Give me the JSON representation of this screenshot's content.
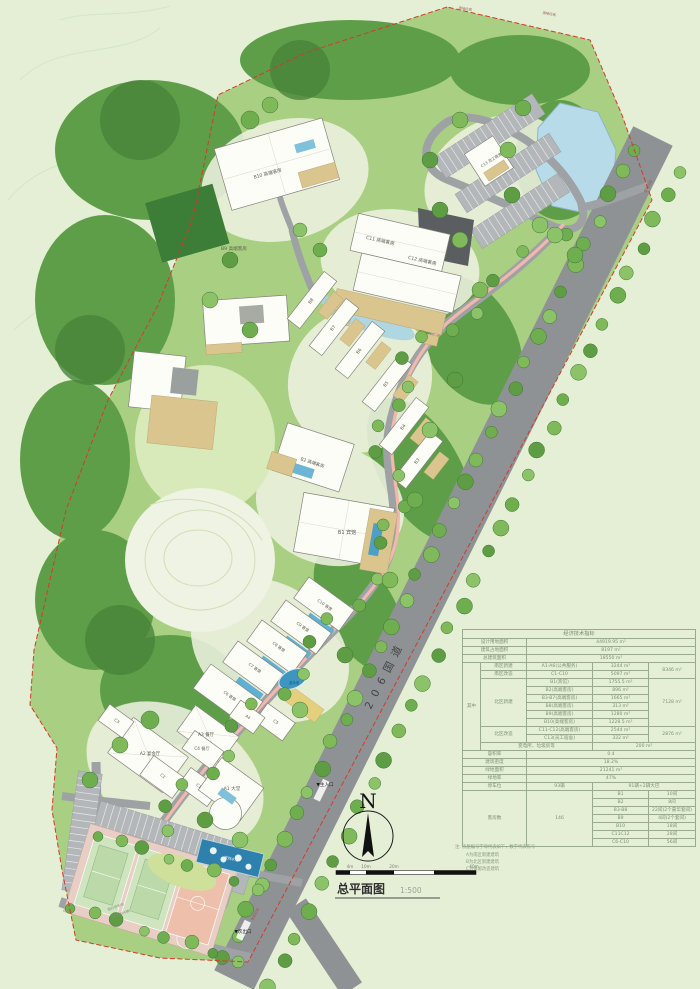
{
  "page": {
    "title": "总平面图",
    "scale": "1:500"
  },
  "north_label": "N",
  "scalebar": {
    "ticks": [
      "0",
      "4m",
      "10m",
      "20m",
      "40m"
    ]
  },
  "notes": {
    "title": "注: 房屋编号字母代表如下，数字代表栋号",
    "lines": [
      "A为南区新建建筑",
      "B为北区新建建筑",
      "C为保留改造建筑"
    ]
  },
  "table": {
    "title": "经济技术指标",
    "rows": [
      [
        {
          "t": "设计用地面积",
          "cs": 2
        },
        {
          "t": "44919.95 m²",
          "cs": 3
        }
      ],
      [
        {
          "t": "建筑占地面积",
          "cs": 2
        },
        {
          "t": "8197 m²",
          "cs": 3
        }
      ],
      [
        {
          "t": "总建筑面积",
          "cs": 2
        },
        {
          "t": "18550 m²",
          "cs": 3
        }
      ],
      [
        {
          "t": "其中",
          "rs": 11
        },
        {
          "t": "南区新建"
        },
        {
          "t": "A1-A6(公共服务)"
        },
        {
          "t": "3244 m²"
        },
        {
          "t": "8346 m²",
          "rs": 2
        }
      ],
      [
        {
          "t": "南区改造"
        },
        {
          "t": "C1-C10"
        },
        {
          "t": "5097 m²"
        }
      ],
      [
        {
          "t": "北区新建",
          "rs": 6
        },
        {
          "t": "B1(宾馆)"
        },
        {
          "t": "1755.5 m²"
        },
        {
          "t": "7128 m²",
          "rs": 6
        }
      ],
      [
        {
          "t": "B2(高端客房)"
        },
        {
          "t": "896 m²"
        }
      ],
      [
        {
          "t": "B3-B7(高端客房)"
        },
        {
          "t": "1665 m²"
        }
      ],
      [
        {
          "t": "B8(高端客房)"
        },
        {
          "t": "313 m²"
        }
      ],
      [
        {
          "t": "B9(高端客房)"
        },
        {
          "t": "1280 m²"
        }
      ],
      [
        {
          "t": "B10(高端客房)"
        },
        {
          "t": "1228.5 m²"
        }
      ],
      [
        {
          "t": "北区改造",
          "rs": 2
        },
        {
          "t": "C11-C12(高端客房)"
        },
        {
          "t": "2544 m²"
        },
        {
          "t": "2876 m²",
          "rs": 2
        }
      ],
      [
        {
          "t": "C13(员工宿舍)"
        },
        {
          "t": "332 m²"
        }
      ],
      [
        {
          "t": "变电所、垃圾房等",
          "cs": 2
        },
        {
          "t": "200 m²",
          "cs": 2
        }
      ],
      [
        {
          "t": "容积率",
          "cs": 2
        },
        {
          "t": "0.4",
          "cs": 3
        }
      ],
      [
        {
          "t": "建筑密度",
          "cs": 2
        },
        {
          "t": "18.2%",
          "cs": 3
        }
      ],
      [
        {
          "t": "绿地面积",
          "cs": 2
        },
        {
          "t": "21241 m²",
          "cs": 3
        }
      ],
      [
        {
          "t": "绿地率",
          "cs": 2
        },
        {
          "t": "47%",
          "cs": 3
        }
      ],
      [
        {
          "t": "停车位",
          "cs": 2
        },
        {
          "t": "93辆"
        },
        {
          "t": "91辆+2辆大巴",
          "cs": 2
        }
      ],
      [
        {
          "t": "客房数",
          "cs": 2,
          "rs": 7
        },
        {
          "t": "146",
          "rs": 7
        },
        {
          "t": "B1"
        },
        {
          "t": "10间"
        }
      ],
      [
        {
          "t": "B2"
        },
        {
          "t": "8间"
        }
      ],
      [
        {
          "t": "B3-B8"
        },
        {
          "t": "22间(2个豪华套间)"
        }
      ],
      [
        {
          "t": "B9"
        },
        {
          "t": "4间(2个套间)"
        }
      ],
      [
        {
          "t": "B10"
        },
        {
          "t": "18间"
        }
      ],
      [
        {
          "t": "C11C12"
        },
        {
          "t": "28间"
        }
      ],
      [
        {
          "t": "C6-C10"
        },
        {
          "t": "56间"
        }
      ]
    ]
  },
  "map_labels": [
    {
      "n": "label-b10",
      "t": "B10 高端客房",
      "x": 268,
      "y": 175,
      "r": -15,
      "s": 4.6
    },
    {
      "n": "label-b9",
      "t": "B9 高端客房",
      "x": 234,
      "y": 250,
      "r": 0,
      "s": 4.6
    },
    {
      "n": "label-c11",
      "t": "C11 高端客房",
      "x": 380,
      "y": 242,
      "r": 13,
      "s": 4.6
    },
    {
      "n": "label-c12",
      "t": "C12 高端客房",
      "x": 422,
      "y": 262,
      "r": 13,
      "s": 4.6
    },
    {
      "n": "label-c13",
      "t": "C13 员工宿舍",
      "x": 492,
      "y": 161,
      "r": -32,
      "s": 3.8
    },
    {
      "n": "label-b8",
      "t": "B8",
      "x": 312,
      "y": 302,
      "r": -52,
      "s": 4.4
    },
    {
      "n": "label-b7",
      "t": "B7",
      "x": 334,
      "y": 329,
      "r": -52,
      "s": 4.4
    },
    {
      "n": "label-b6",
      "t": "B6",
      "x": 360,
      "y": 352,
      "r": -52,
      "s": 4.4
    },
    {
      "n": "label-b5",
      "t": "B5",
      "x": 387,
      "y": 385,
      "r": -52,
      "s": 4.4
    },
    {
      "n": "label-b4",
      "t": "B4",
      "x": 404,
      "y": 428,
      "r": -52,
      "s": 4.4
    },
    {
      "n": "label-b3",
      "t": "B3",
      "x": 418,
      "y": 462,
      "r": -52,
      "s": 4.4
    },
    {
      "n": "label-b2",
      "t": "B2 高端客房",
      "x": 312,
      "y": 464,
      "r": 18,
      "s": 4.4
    },
    {
      "n": "label-b1",
      "t": "B1 宾馆",
      "x": 347,
      "y": 534,
      "r": 0,
      "s": 5
    },
    {
      "n": "label-c10",
      "t": "C10 客房",
      "x": 324,
      "y": 606,
      "r": 36,
      "s": 4
    },
    {
      "n": "label-c9",
      "t": "C9 客房",
      "x": 302,
      "y": 628,
      "r": 36,
      "s": 4
    },
    {
      "n": "label-c8",
      "t": "C8 客房",
      "x": 278,
      "y": 648,
      "r": 36,
      "s": 4
    },
    {
      "n": "label-c7",
      "t": "C7 客房",
      "x": 254,
      "y": 669,
      "r": 36,
      "s": 4
    },
    {
      "n": "label-c6",
      "t": "C6 客房",
      "x": 229,
      "y": 697,
      "r": 36,
      "s": 4
    },
    {
      "n": "label-c5",
      "t": "C5",
      "x": 275,
      "y": 723,
      "r": 36,
      "s": 4
    },
    {
      "n": "label-a4",
      "t": "A4",
      "x": 247,
      "y": 718,
      "r": 36,
      "s": 4
    },
    {
      "n": "label-a3",
      "t": "A3 餐厅",
      "x": 206,
      "y": 736,
      "r": 0,
      "s": 4.4
    },
    {
      "n": "label-c4",
      "t": "C4 餐厅",
      "x": 202,
      "y": 750,
      "r": 0,
      "s": 4.2
    },
    {
      "n": "label-a2",
      "t": "A2 宴会厅",
      "x": 150,
      "y": 755,
      "r": 0,
      "s": 4.4
    },
    {
      "n": "label-a1",
      "t": "A1 大堂",
      "x": 232,
      "y": 790,
      "r": 0,
      "s": 4.6
    },
    {
      "n": "label-c3",
      "t": "C3",
      "x": 116,
      "y": 722,
      "r": 36,
      "s": 4
    },
    {
      "n": "label-c2",
      "t": "C2",
      "x": 162,
      "y": 777,
      "r": 36,
      "s": 4
    },
    {
      "n": "label-c1",
      "t": "C1",
      "x": 198,
      "y": 787,
      "r": 36,
      "s": 4
    },
    {
      "n": "label-national-road",
      "t": "206国道",
      "x": 388,
      "y": 676,
      "r": -63,
      "s": 10.5,
      "c": "#434343",
      "ls": 7
    },
    {
      "n": "main-entrance-marker",
      "t": "▼主入口",
      "x": 325,
      "y": 786,
      "r": 0,
      "s": 4.6,
      "c": "#1f1f1f"
    },
    {
      "n": "secondary-exit-marker",
      "t": "▼次出口",
      "x": 243,
      "y": 933,
      "r": 0,
      "s": 4.6,
      "c": "#1f1f1f"
    },
    {
      "n": "boundary-label",
      "t": "用地红线",
      "x": 465,
      "y": 10,
      "r": 9,
      "s": 3.4,
      "c": "#97564c"
    },
    {
      "n": "boundary-label",
      "t": "用地红线",
      "x": 549,
      "y": 15,
      "r": 10,
      "s": 3.4,
      "c": "#97564c"
    },
    {
      "n": "boundary-label",
      "t": "用地红线",
      "x": 649,
      "y": 187,
      "r": -62,
      "s": 3.4,
      "c": "#97564c"
    },
    {
      "n": "boundary-label",
      "t": "用地红线",
      "x": 256,
      "y": 915,
      "r": -62,
      "s": 3.4,
      "c": "#97564c"
    },
    {
      "n": "label-water-feature",
      "t": "景观水池",
      "x": 231,
      "y": 860,
      "r": 13,
      "s": 3.6,
      "c": "#eaf4fa"
    },
    {
      "n": "label-swimming-pool",
      "t": "游泳池",
      "x": 294,
      "y": 684,
      "r": 0,
      "s": 3.4,
      "c": "#11597c"
    },
    {
      "n": "label-temp-parking-1",
      "t": "临时停车场",
      "x": 116,
      "y": 908,
      "r": -20,
      "s": 3.4,
      "c": "#8b8b84"
    },
    {
      "n": "label-temp-parking-2",
      "t": "可容纳94辆",
      "x": 121,
      "y": 915,
      "r": -20,
      "s": 3.4,
      "c": "#8b8b84"
    }
  ]
}
